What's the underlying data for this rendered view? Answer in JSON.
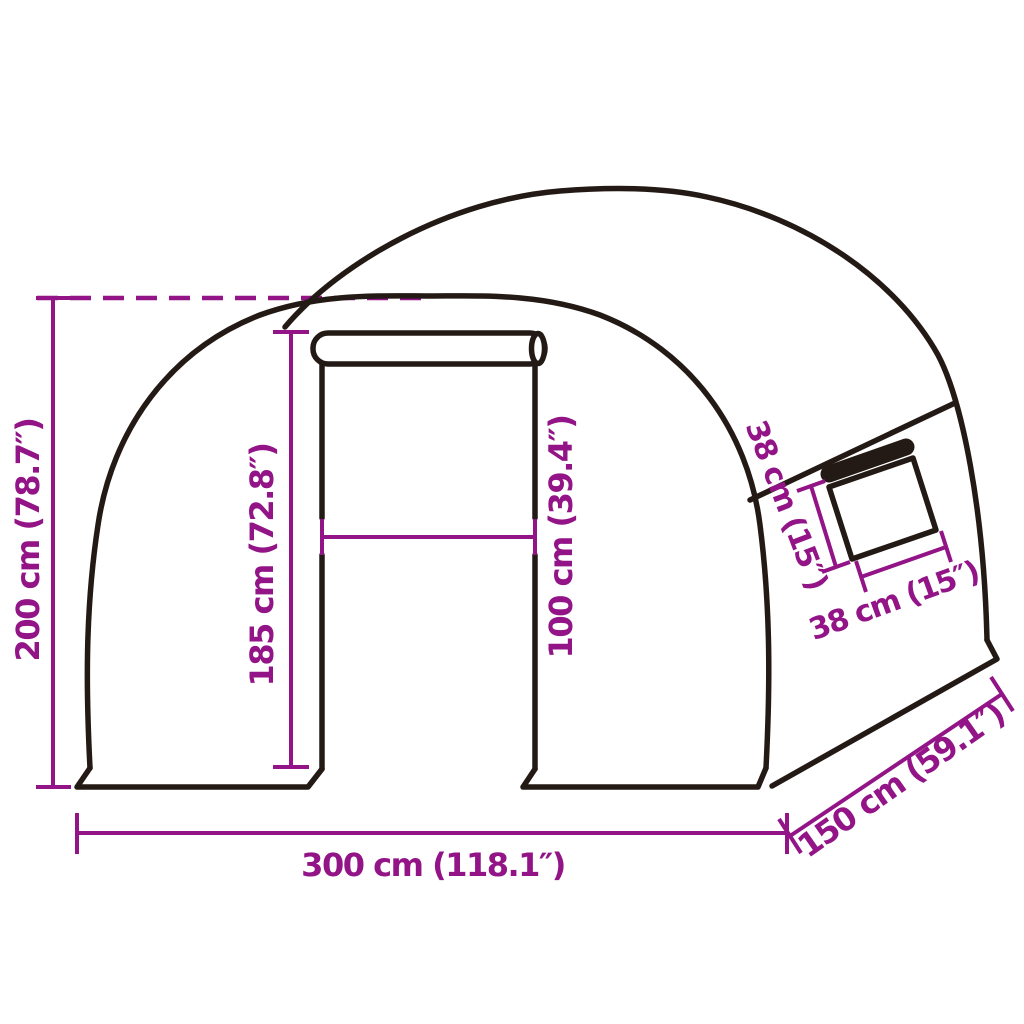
{
  "diagram": {
    "type": "product-dimension-diagram",
    "subject": "tunnel greenhouse with roll-up door and side window",
    "background_color": "#ffffff",
    "accent_color": "#921487",
    "outline_color": "#241a15",
    "dimensions": {
      "total_height": "200 cm (78.7″)",
      "door_height": "185 cm (72.8″)",
      "door_width": "100 cm (39.4″)",
      "window_height": "38 cm (15″)",
      "window_width": "38 cm (15″)",
      "total_width": "300 cm (118.1″)",
      "total_depth": "150 cm (59.1″)"
    }
  }
}
